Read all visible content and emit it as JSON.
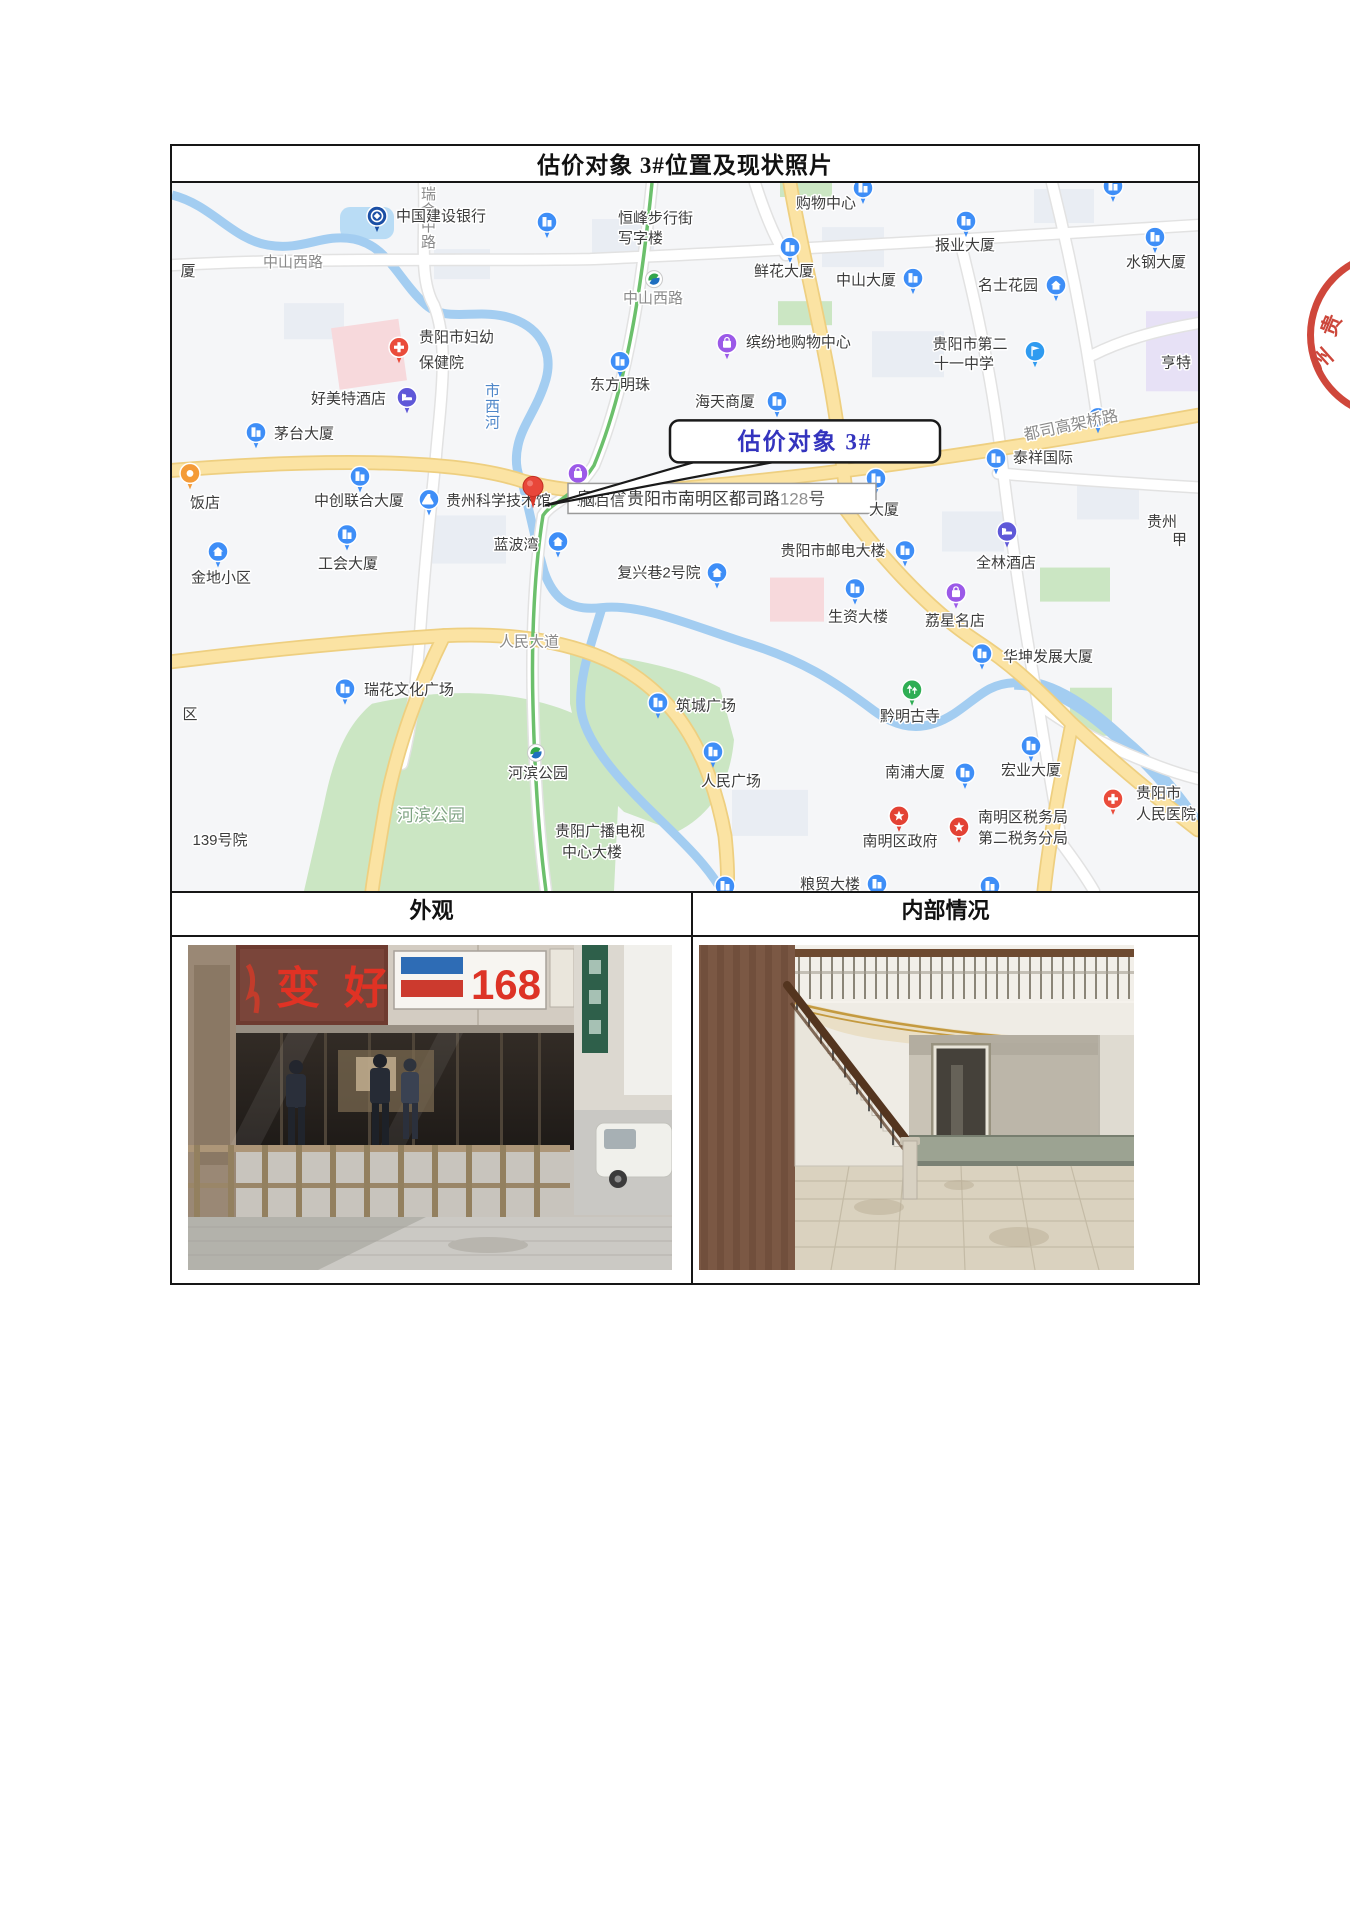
{
  "document": {
    "title": "估价对象 3#位置及现状照片",
    "exterior_header": "外观",
    "interior_header": "内部情况"
  },
  "colors": {
    "callout_text": "#3434BE",
    "seal_red": "#C8372A",
    "map_road_yellow": "#FBE3A3",
    "map_water_blue": "#A3CDF1",
    "map_park_green": "#CBE6C3"
  },
  "map": {
    "callout_text": "估价对象 3#",
    "address_prefix": "贵州省贵阳市南明区都司路",
    "address_number": "128",
    "address_suffix": "号",
    "labels": [
      {
        "t": "中山西路",
        "x": 121,
        "y": 84,
        "c": "road",
        "a": "m"
      },
      {
        "t": "瑞金中路",
        "x": 249,
        "y": 16,
        "c": "road",
        "v": 1
      },
      {
        "t": "中山西路",
        "x": 481,
        "y": 120,
        "c": "road",
        "a": "m"
      },
      {
        "t": "人民大道",
        "x": 357,
        "y": 463,
        "c": "road",
        "a": "m"
      },
      {
        "t": "都司高架桥路",
        "x": 900,
        "y": 247,
        "c": "road",
        "a": "m",
        "r": -12,
        "fs": 16
      },
      {
        "t": "市西河",
        "x": 313,
        "y": 212,
        "c": "water",
        "v": 1
      },
      {
        "t": "河滨公园",
        "x": 259,
        "y": 637,
        "c": "park",
        "a": "m",
        "fs": 17
      },
      {
        "t": "中国建设银行",
        "x": 224,
        "y": 38,
        "a": "s"
      },
      {
        "t": "恒峰步行街",
        "x": 446,
        "y": 40,
        "a": "s"
      },
      {
        "t": "写字楼",
        "x": 446,
        "y": 60,
        "a": "s"
      },
      {
        "t": "购物中心",
        "x": 654,
        "y": 25,
        "a": "m"
      },
      {
        "t": "报业大厦",
        "x": 793,
        "y": 67,
        "a": "m"
      },
      {
        "t": "鲜花大厦",
        "x": 612,
        "y": 93,
        "a": "m"
      },
      {
        "t": "中山大厦",
        "x": 694,
        "y": 102,
        "a": "m"
      },
      {
        "t": "名士花园",
        "x": 836,
        "y": 107,
        "a": "m"
      },
      {
        "t": "水钢大厦",
        "x": 984,
        "y": 84,
        "a": "m"
      },
      {
        "t": "贵阳市第二",
        "x": 798,
        "y": 166,
        "a": "m"
      },
      {
        "t": "十一中学",
        "x": 792,
        "y": 185,
        "a": "m"
      },
      {
        "t": "亨特",
        "x": 1004,
        "y": 184,
        "a": "m"
      },
      {
        "t": "贵阳市妇幼",
        "x": 247,
        "y": 159,
        "a": "s"
      },
      {
        "t": "保健院",
        "x": 247,
        "y": 184,
        "a": "s"
      },
      {
        "t": "好美特酒店",
        "x": 139,
        "y": 220,
        "a": "s"
      },
      {
        "t": "东方明珠",
        "x": 448,
        "y": 206,
        "a": "m"
      },
      {
        "t": "海天商厦",
        "x": 553,
        "y": 223,
        "a": "m"
      },
      {
        "t": "缤纷地购物中心",
        "x": 574,
        "y": 164,
        "a": "s"
      },
      {
        "t": "茅台大厦",
        "x": 102,
        "y": 255,
        "a": "s"
      },
      {
        "t": "厦",
        "x": 16,
        "y": 93,
        "a": "m"
      },
      {
        "t": "饭店",
        "x": 33,
        "y": 324,
        "a": "m"
      },
      {
        "t": "中创联合大厦",
        "x": 187,
        "y": 322,
        "a": "m"
      },
      {
        "t": "贵州科学技术馆",
        "x": 274,
        "y": 322,
        "a": "s"
      },
      {
        "t": "脑百信",
        "x": 408,
        "y": 322,
        "a": "s",
        "top": 1
      },
      {
        "t": "工会大厦",
        "x": 176,
        "y": 385,
        "a": "m"
      },
      {
        "t": "金地小区",
        "x": 49,
        "y": 399,
        "a": "m"
      },
      {
        "t": "蓝波湾",
        "x": 344,
        "y": 366,
        "a": "m"
      },
      {
        "t": "复兴巷2号院",
        "x": 487,
        "y": 394,
        "a": "m"
      },
      {
        "t": "贵阳市邮电大楼",
        "x": 661,
        "y": 372,
        "a": "m"
      },
      {
        "t": "大厦",
        "x": 712,
        "y": 331,
        "a": "m",
        "top": 1
      },
      {
        "t": "全林酒店",
        "x": 834,
        "y": 384,
        "a": "m"
      },
      {
        "t": "泰祥国际",
        "x": 841,
        "y": 279,
        "a": "s"
      },
      {
        "t": "贵州",
        "x": 975,
        "y": 343,
        "a": "s"
      },
      {
        "t": "甲",
        "x": 1000,
        "y": 361,
        "a": "s"
      },
      {
        "t": "生资大楼",
        "x": 686,
        "y": 438,
        "a": "m"
      },
      {
        "t": "荔星名店",
        "x": 783,
        "y": 442,
        "a": "m"
      },
      {
        "t": "华坤发展大厦",
        "x": 831,
        "y": 478,
        "a": "s"
      },
      {
        "t": "瑞花文化广场",
        "x": 192,
        "y": 511,
        "a": "s"
      },
      {
        "t": "筑城广场",
        "x": 504,
        "y": 527,
        "a": "s"
      },
      {
        "t": "黔明古寺",
        "x": 738,
        "y": 537,
        "a": "m"
      },
      {
        "t": "人民广场",
        "x": 559,
        "y": 602,
        "a": "m"
      },
      {
        "t": "南浦大厦",
        "x": 743,
        "y": 593,
        "a": "m"
      },
      {
        "t": "宏业大厦",
        "x": 859,
        "y": 591,
        "a": "m"
      },
      {
        "t": "南明区政府",
        "x": 728,
        "y": 662,
        "a": "m"
      },
      {
        "t": "南明区税务局",
        "x": 806,
        "y": 638,
        "a": "s"
      },
      {
        "t": "第二税务分局",
        "x": 806,
        "y": 659,
        "a": "s"
      },
      {
        "t": "贵阳市",
        "x": 964,
        "y": 614,
        "a": "s"
      },
      {
        "t": "人民医院",
        "x": 964,
        "y": 635,
        "a": "s"
      },
      {
        "t": "河滨公园",
        "x": 366,
        "y": 594,
        "a": "m"
      },
      {
        "t": "139号院",
        "x": 48,
        "y": 661,
        "a": "m"
      },
      {
        "t": "贵阳广播电视",
        "x": 428,
        "y": 652,
        "a": "m"
      },
      {
        "t": "中心大楼",
        "x": 420,
        "y": 673,
        "a": "m"
      },
      {
        "t": "粮贸大楼",
        "x": 658,
        "y": 705,
        "a": "m"
      },
      {
        "t": "区",
        "x": 18,
        "y": 535,
        "a": "m"
      }
    ],
    "pins": [
      {
        "x": 205,
        "y": 33,
        "k": "k"
      },
      {
        "x": 375,
        "y": 39,
        "k": "b"
      },
      {
        "x": 618,
        "y": 64,
        "k": "b"
      },
      {
        "x": 741,
        "y": 95,
        "k": "b"
      },
      {
        "x": 794,
        "y": 38,
        "k": "b"
      },
      {
        "x": 884,
        "y": 102,
        "k": "r"
      },
      {
        "x": 983,
        "y": 54,
        "k": "b"
      },
      {
        "x": 863,
        "y": 168,
        "k": "f"
      },
      {
        "x": 84,
        "y": 249,
        "k": "b"
      },
      {
        "x": 227,
        "y": 164,
        "k": "+"
      },
      {
        "x": 235,
        "y": 214,
        "k": "h"
      },
      {
        "x": 448,
        "y": 178,
        "k": "b"
      },
      {
        "x": 605,
        "y": 218,
        "k": "b"
      },
      {
        "x": 555,
        "y": 160,
        "k": "s"
      },
      {
        "x": 257,
        "y": 316,
        "k": "l"
      },
      {
        "x": 188,
        "y": 293,
        "k": "b"
      },
      {
        "x": 175,
        "y": 351,
        "k": "b"
      },
      {
        "x": 46,
        "y": 368,
        "k": "r"
      },
      {
        "x": 386,
        "y": 358,
        "k": "r"
      },
      {
        "x": 173,
        "y": 505,
        "k": "b"
      },
      {
        "x": 486,
        "y": 519,
        "k": "b"
      },
      {
        "x": 541,
        "y": 568,
        "k": "b"
      },
      {
        "x": 740,
        "y": 506,
        "k": "t"
      },
      {
        "x": 683,
        "y": 405,
        "k": "b"
      },
      {
        "x": 733,
        "y": 367,
        "k": "b"
      },
      {
        "x": 784,
        "y": 409,
        "k": "s"
      },
      {
        "x": 835,
        "y": 348,
        "k": "h"
      },
      {
        "x": 824,
        "y": 275,
        "k": "b"
      },
      {
        "x": 810,
        "y": 470,
        "k": "b"
      },
      {
        "x": 793,
        "y": 589,
        "k": "b"
      },
      {
        "x": 859,
        "y": 562,
        "k": "b"
      },
      {
        "x": 727,
        "y": 632,
        "k": "g"
      },
      {
        "x": 787,
        "y": 643,
        "k": "g"
      },
      {
        "x": 704,
        "y": 295,
        "k": "b"
      },
      {
        "x": 545,
        "y": 389,
        "k": "r"
      },
      {
        "x": 18,
        "y": 290,
        "k": "o"
      },
      {
        "x": 705,
        "y": 700,
        "k": "b"
      },
      {
        "x": 941,
        "y": 615,
        "k": "+"
      },
      {
        "x": 406,
        "y": 290,
        "k": "s"
      },
      {
        "x": 482,
        "y": 96,
        "k": "m"
      },
      {
        "x": 364,
        "y": 569,
        "k": "m"
      },
      {
        "x": 553,
        "y": 702,
        "k": "b"
      },
      {
        "x": 818,
        "y": 702,
        "k": "b"
      },
      {
        "x": 926,
        "y": 234,
        "k": "b"
      },
      {
        "x": 691,
        "y": 5,
        "k": "b"
      },
      {
        "x": 941,
        "y": 3,
        "k": "b"
      }
    ]
  },
  "seal": {
    "char1": "贵",
    "char2": "州"
  },
  "photos": {
    "exterior_sign_number": "168",
    "exterior_sign_text": "变好"
  }
}
